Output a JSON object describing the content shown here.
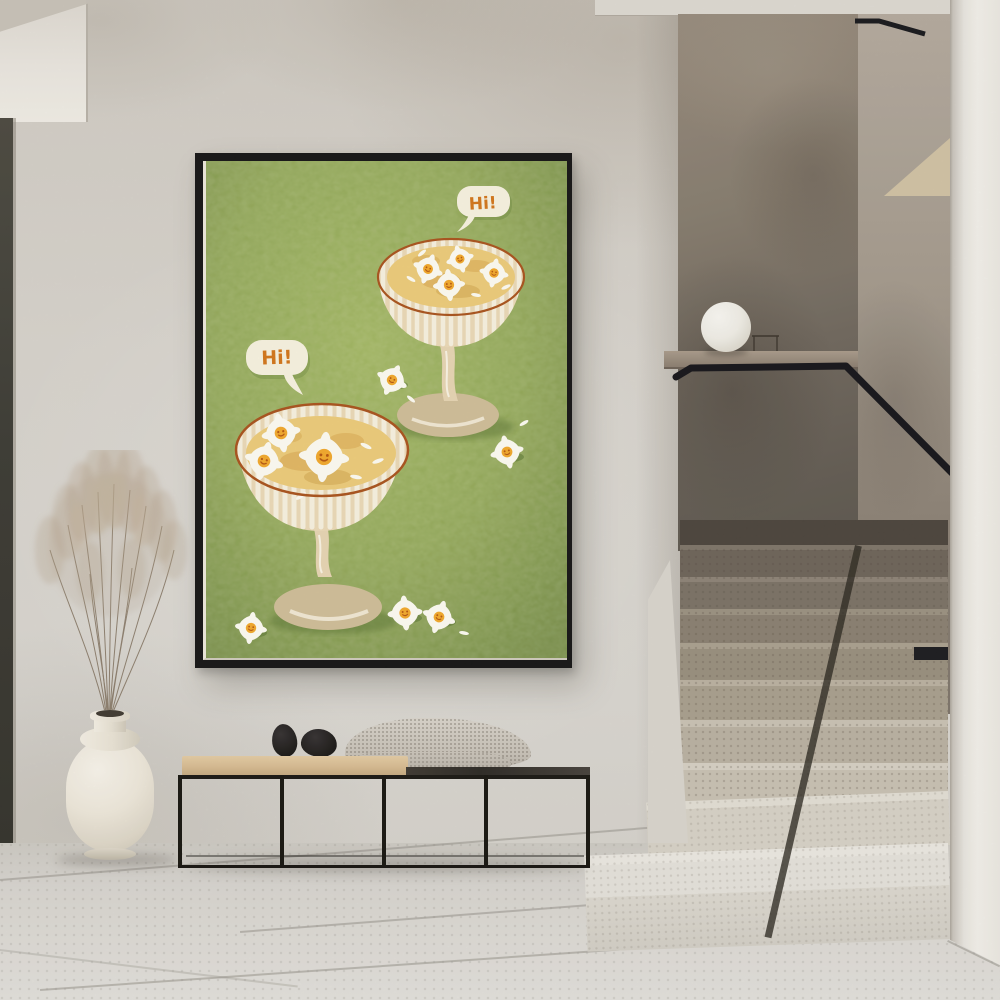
{
  "poster": {
    "bubble_left_text": "Hi!",
    "bubble_right_text": "Hi!"
  },
  "palette": {
    "wall": "#d3cfc8",
    "poster_green": "#8ba24e",
    "accent_orange": "#d2751a",
    "frame_black": "#141414",
    "handrail_black": "#16161a",
    "stair_wall_dark": "#6e665c",
    "step_light": "#e6e3db",
    "bench_cushion_tan": "#d8bd93",
    "bench_top_dark": "#34302a",
    "throw_gray": "#ccc6bc",
    "vase_cream": "#efe9dc",
    "pampas_tan": "#b3a088",
    "lamp_white": "#f2f0ea",
    "floor_gray": "#dbd8d3"
  }
}
